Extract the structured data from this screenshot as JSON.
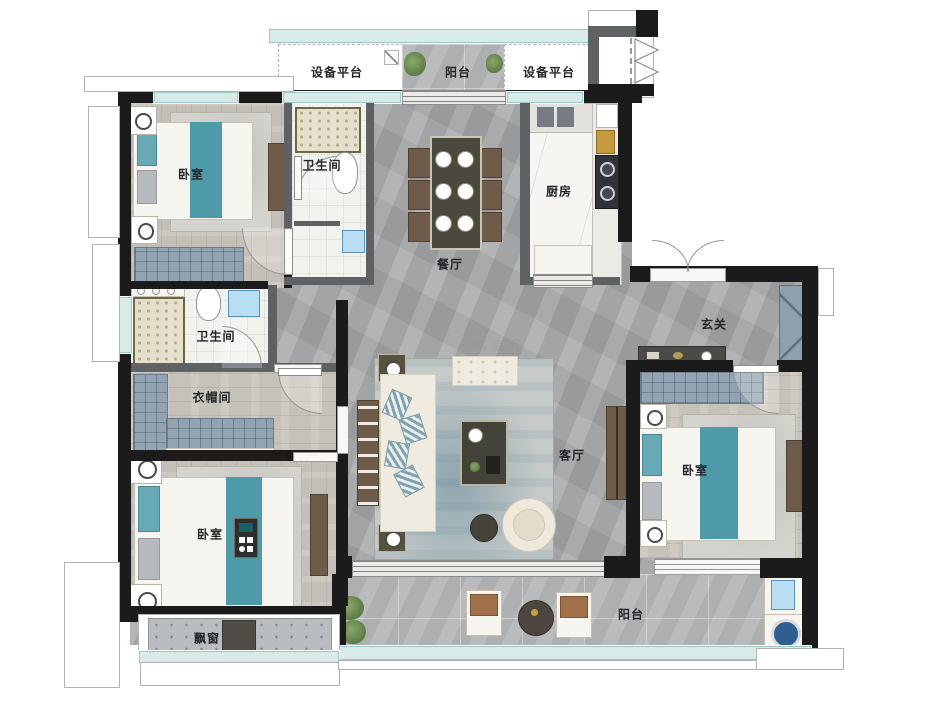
{
  "plan": {
    "type": "apartment-floor-plan",
    "rooms": [
      {
        "id": "equip-platform-left",
        "label": "设备平台"
      },
      {
        "id": "balcony-top",
        "label": "阳台"
      },
      {
        "id": "equip-platform-right",
        "label": "设备平台"
      },
      {
        "id": "bedroom-top-left",
        "label": "卧室"
      },
      {
        "id": "bathroom-top",
        "label": "卫生间"
      },
      {
        "id": "dining-room",
        "label": "餐厅"
      },
      {
        "id": "kitchen",
        "label": "厨房"
      },
      {
        "id": "foyer",
        "label": "玄关"
      },
      {
        "id": "bathroom-middle",
        "label": "卫生间"
      },
      {
        "id": "cloakroom",
        "label": "衣帽间"
      },
      {
        "id": "bedroom-bottom-left",
        "label": "卧室"
      },
      {
        "id": "living-room",
        "label": "客厅"
      },
      {
        "id": "bedroom-right",
        "label": "卧室"
      },
      {
        "id": "bay-window",
        "label": "飘窗"
      },
      {
        "id": "balcony-bottom",
        "label": "阳台"
      }
    ],
    "watermark": {
      "text": "楼盘网"
    },
    "colors": {
      "wall": "#1b1b1b",
      "partition": "#5e6265",
      "window_glass": "#d8ebe9",
      "wood_floor": "#cbc6bd",
      "concrete_floor": "#a6a8a9",
      "balcony_tile": "#b4b6b7",
      "accent_teal": "#4f9aa9",
      "cabinet_slate": "#93a3b1",
      "label_text": "#23262a"
    }
  }
}
